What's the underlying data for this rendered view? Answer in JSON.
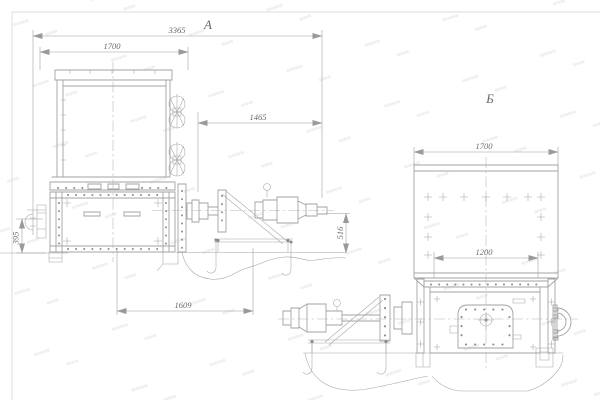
{
  "drawing": {
    "view_a": {
      "label": "А",
      "dim_overall_length": "3365",
      "dim_body_width": "1700",
      "dim_drive_length": "1465",
      "dim_support_height": "395",
      "dim_foundation_span": "1609",
      "dim_axis_height": "516"
    },
    "view_b": {
      "label": "Б",
      "dim_body_width": "1700",
      "dim_opening_width": "1200"
    },
    "colors": {
      "background": "#ffffff",
      "line": "#a3a3a3",
      "dim_line": "#9a9a9a",
      "text": "#6b6b6b",
      "centerline": "#b5b5b5",
      "bolt": "#8c8c8c",
      "frame": "#dddddd"
    }
  }
}
